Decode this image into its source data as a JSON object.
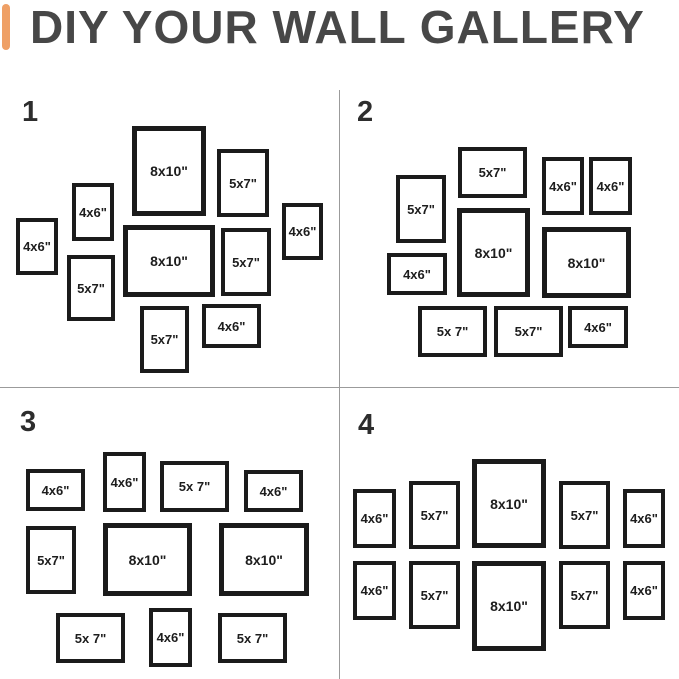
{
  "title": "DIY YOUR WALL GALLERY",
  "colors": {
    "background": "#FFFFFF",
    "accent": "#EFA066",
    "title_text": "#474747",
    "divider": "#9B9B9B",
    "frame_border": "#1B1B1B",
    "label_text": "#1D1D1D",
    "number_text": "#2D2D2D"
  },
  "layouts": [
    {
      "number": "1",
      "number_pos": {
        "x": 22,
        "y": 98
      },
      "frames": [
        {
          "x": 132,
          "y": 126,
          "w": 74,
          "h": 90,
          "size": "8x10\"",
          "border": 5,
          "font": 14
        },
        {
          "x": 217,
          "y": 149,
          "w": 52,
          "h": 68,
          "size": "5x7\"",
          "border": 4,
          "font": 13
        },
        {
          "x": 72,
          "y": 183,
          "w": 42,
          "h": 58,
          "size": "4x6\"",
          "border": 4,
          "font": 13
        },
        {
          "x": 16,
          "y": 218,
          "w": 42,
          "h": 57,
          "size": "4x6\"",
          "border": 4,
          "font": 13
        },
        {
          "x": 282,
          "y": 203,
          "w": 41,
          "h": 57,
          "size": "4x6\"",
          "border": 4,
          "font": 13
        },
        {
          "x": 123,
          "y": 225,
          "w": 92,
          "h": 72,
          "size": "8x10\"",
          "border": 5,
          "font": 14
        },
        {
          "x": 221,
          "y": 228,
          "w": 50,
          "h": 68,
          "size": "5x7\"",
          "border": 4,
          "font": 13
        },
        {
          "x": 67,
          "y": 255,
          "w": 48,
          "h": 66,
          "size": "5x7\"",
          "border": 4,
          "font": 13
        },
        {
          "x": 140,
          "y": 306,
          "w": 49,
          "h": 67,
          "size": "5x7\"",
          "border": 4,
          "font": 13
        },
        {
          "x": 202,
          "y": 304,
          "w": 59,
          "h": 44,
          "size": "4x6\"",
          "border": 4,
          "font": 13
        }
      ]
    },
    {
      "number": "2",
      "number_pos": {
        "x": 357,
        "y": 98
      },
      "frames": [
        {
          "x": 458,
          "y": 147,
          "w": 69,
          "h": 51,
          "size": "5x7\"",
          "border": 4,
          "font": 13
        },
        {
          "x": 542,
          "y": 157,
          "w": 42,
          "h": 58,
          "size": "4x6\"",
          "border": 4,
          "font": 13
        },
        {
          "x": 589,
          "y": 157,
          "w": 43,
          "h": 58,
          "size": "4x6\"",
          "border": 4,
          "font": 13
        },
        {
          "x": 396,
          "y": 175,
          "w": 50,
          "h": 68,
          "size": "5x7\"",
          "border": 4,
          "font": 13
        },
        {
          "x": 457,
          "y": 208,
          "w": 73,
          "h": 89,
          "size": "8x10\"",
          "border": 5,
          "font": 14
        },
        {
          "x": 542,
          "y": 227,
          "w": 89,
          "h": 71,
          "size": "8x10\"",
          "border": 5,
          "font": 14
        },
        {
          "x": 387,
          "y": 253,
          "w": 60,
          "h": 42,
          "size": "4x6\"",
          "border": 4,
          "font": 13
        },
        {
          "x": 418,
          "y": 306,
          "w": 69,
          "h": 51,
          "size": "5x 7\"",
          "border": 4,
          "font": 13
        },
        {
          "x": 494,
          "y": 306,
          "w": 69,
          "h": 51,
          "size": "5x7\"",
          "border": 4,
          "font": 13
        },
        {
          "x": 568,
          "y": 306,
          "w": 60,
          "h": 42,
          "size": "4x6\"",
          "border": 4,
          "font": 13
        }
      ]
    },
    {
      "number": "3",
      "number_pos": {
        "x": 20,
        "y": 408
      },
      "frames": [
        {
          "x": 26,
          "y": 469,
          "w": 59,
          "h": 42,
          "size": "4x6\"",
          "border": 4,
          "font": 13
        },
        {
          "x": 103,
          "y": 452,
          "w": 43,
          "h": 60,
          "size": "4x6\"",
          "border": 4,
          "font": 13
        },
        {
          "x": 160,
          "y": 461,
          "w": 69,
          "h": 51,
          "size": "5x 7\"",
          "border": 4,
          "font": 13
        },
        {
          "x": 244,
          "y": 470,
          "w": 59,
          "h": 42,
          "size": "4x6\"",
          "border": 4,
          "font": 13
        },
        {
          "x": 26,
          "y": 526,
          "w": 50,
          "h": 68,
          "size": "5x7\"",
          "border": 4,
          "font": 13
        },
        {
          "x": 103,
          "y": 523,
          "w": 89,
          "h": 73,
          "size": "8x10\"",
          "border": 5,
          "font": 14
        },
        {
          "x": 219,
          "y": 523,
          "w": 90,
          "h": 73,
          "size": "8x10\"",
          "border": 5,
          "font": 14
        },
        {
          "x": 56,
          "y": 613,
          "w": 69,
          "h": 50,
          "size": "5x 7\"",
          "border": 4,
          "font": 13
        },
        {
          "x": 149,
          "y": 608,
          "w": 43,
          "h": 59,
          "size": "4x6\"",
          "border": 4,
          "font": 13
        },
        {
          "x": 218,
          "y": 613,
          "w": 69,
          "h": 50,
          "size": "5x 7\"",
          "border": 4,
          "font": 13
        }
      ]
    },
    {
      "number": "4",
      "number_pos": {
        "x": 358,
        "y": 411
      },
      "frames": [
        {
          "x": 353,
          "y": 489,
          "w": 43,
          "h": 59,
          "size": "4x6\"",
          "border": 4,
          "font": 13
        },
        {
          "x": 409,
          "y": 481,
          "w": 51,
          "h": 68,
          "size": "5x7\"",
          "border": 4,
          "font": 13
        },
        {
          "x": 472,
          "y": 459,
          "w": 74,
          "h": 89,
          "size": "8x10\"",
          "border": 5,
          "font": 14
        },
        {
          "x": 559,
          "y": 481,
          "w": 51,
          "h": 68,
          "size": "5x7\"",
          "border": 4,
          "font": 13
        },
        {
          "x": 623,
          "y": 489,
          "w": 42,
          "h": 59,
          "size": "4x6\"",
          "border": 4,
          "font": 13
        },
        {
          "x": 353,
          "y": 561,
          "w": 43,
          "h": 59,
          "size": "4x6\"",
          "border": 4,
          "font": 13
        },
        {
          "x": 409,
          "y": 561,
          "w": 51,
          "h": 68,
          "size": "5x7\"",
          "border": 4,
          "font": 13
        },
        {
          "x": 472,
          "y": 561,
          "w": 74,
          "h": 90,
          "size": "8x10\"",
          "border": 5,
          "font": 14
        },
        {
          "x": 559,
          "y": 561,
          "w": 51,
          "h": 68,
          "size": "5x7\"",
          "border": 4,
          "font": 13
        },
        {
          "x": 623,
          "y": 561,
          "w": 42,
          "h": 59,
          "size": "4x6\"",
          "border": 4,
          "font": 13
        }
      ]
    }
  ]
}
